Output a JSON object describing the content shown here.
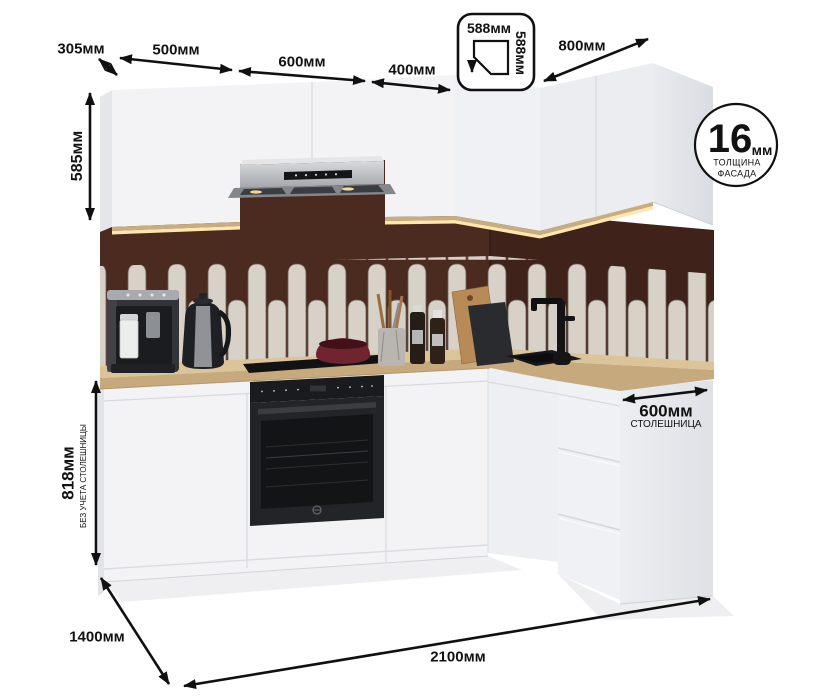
{
  "dimensions": {
    "wall_cabinet_depth": "305мм",
    "cabinet_500": "500мм",
    "cabinet_600": "600мм",
    "cabinet_400": "400мм",
    "corner_cabinet_width": "588мм",
    "corner_cabinet_depth": "588мм",
    "right_run_width": "800мм",
    "wall_cabinet_height": "585мм",
    "base_height": "818мм",
    "base_height_note": "БЕЗ УЧЕТА СТОЛЕШНИЦЫ",
    "countertop_depth": "600мм",
    "countertop_note": "СТОЛЕШНИЦА",
    "total_depth": "1400мм",
    "total_width": "2100мм"
  },
  "facade_badge": {
    "value": "16",
    "unit": "мм",
    "caption_line1": "ТОЛЩИНА",
    "caption_line2": "ФАСАДА"
  },
  "colors": {
    "wall": "#4b2a20",
    "tile": "#d7d1c8",
    "counter": "#dcc49a",
    "cabinet": "#f3f3f5",
    "appliance": "#1b1c1e",
    "underlight": "#ffe7ad",
    "annotation": "#101010"
  }
}
